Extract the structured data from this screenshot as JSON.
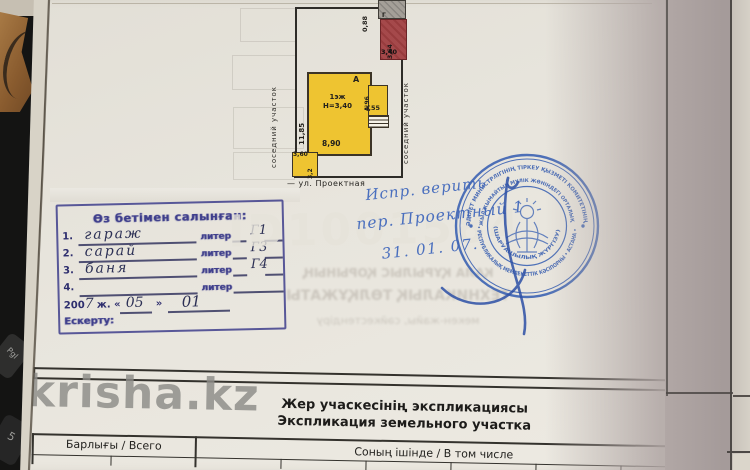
{
  "plan": {
    "neighbor_left": "соседний участок",
    "neighbor_right": "соседний участок",
    "street": "— ул. Проектная",
    "dim_top": "0,88",
    "shed": {
      "letter": "Г"
    },
    "garage": {
      "dim_side": "3,64",
      "dim_bottom": "3,40"
    },
    "house": {
      "letter": "А",
      "storey": "1эж",
      "height": "Н=3,40",
      "dim_left": "11,85",
      "dim_bottom": "8,90"
    },
    "annex": {
      "dim_side": "4,96",
      "dim_bottom": "2,55"
    },
    "bath": {
      "dim_top": "3,60",
      "dim_side": "3,2"
    }
  },
  "stamp_box": {
    "title": "Өз бетімен салынған:",
    "liter_label": "литер",
    "rows": [
      {
        "num": "1.",
        "name": "гараж",
        "liter": "Г1"
      },
      {
        "num": "2.",
        "name": "сарай",
        "liter": "Г3"
      },
      {
        "num": "3.",
        "name": "баня",
        "liter": "Г4"
      },
      {
        "num": "4.",
        "name": "",
        "liter": ""
      }
    ],
    "date_prefix": "200",
    "date_year": "7",
    "date_sep1": "ж. «",
    "date_month": "05",
    "date_sep2": "»",
    "date_day": "01",
    "note_label": "Ескерту:"
  },
  "notes": {
    "line1": "Испр. верить",
    "line2": "пер. Проектный 1",
    "line3": "31. 01. 07."
  },
  "seal": {
    "ring_outer_top": "ӘДІЛЕТ МИНИСТРЛІГІНІҢ ТІРКЕУ ҚЫЗМЕТІ КОМИТЕТІНІҢ",
    "ring_outer_bottom": "• РЕСПУБЛИКАЛЫҚ МЕМЛЕКЕТТІК КӘСІПОРНЫ • АСТАНА •",
    "ring_inner_top": "ЖЫЛЖЫМАЙТЫН МҮЛІК ЖӨНІНДЕГІ ОРТАЛЫҚ",
    "ring_inner_bottom": "(ШАРУАШЫЛЫҚ ЖҮРГІЗУ)"
  },
  "bleed": {
    "line1": "ҚАЛА ҚҰРЫЛЫС ҚОРЫНЫҢ",
    "line2": "ТЕХНИКАЛЫҚ ТӨЛҚҰЖАТЫ",
    "line3": "мекен-жайы, сәйкестендіру"
  },
  "watermark": {
    "site": "krisha.kz",
    "id": "ID1001584"
  },
  "bottom": {
    "heading_kk": "Жер учаскесінің экспликациясы",
    "heading_ru": "Экспликация земельного участка",
    "col_total": "Барлығы / Всего",
    "col_detail": "Соның ішінде / В том числе"
  },
  "debris": {
    "key1": "Pgl",
    "key2": "5"
  }
}
